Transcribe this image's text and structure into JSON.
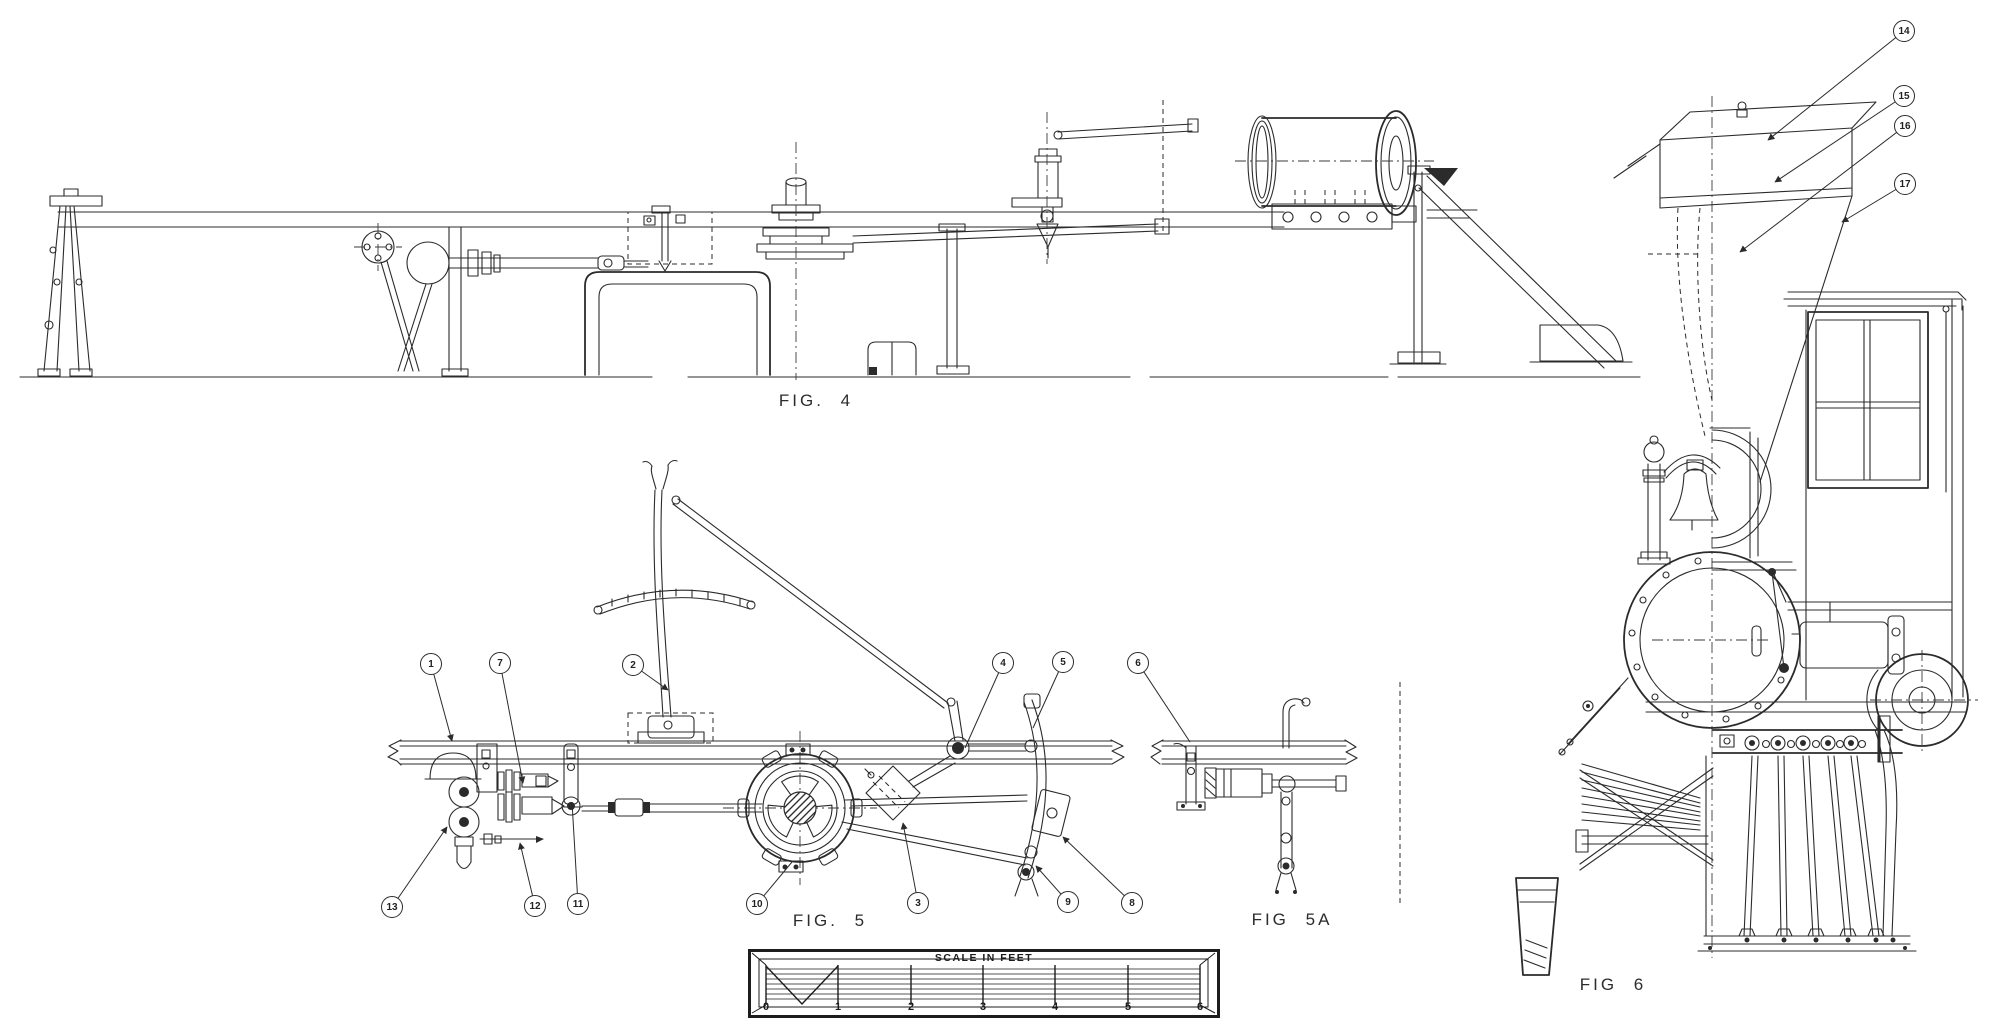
{
  "sheet": {
    "background": "#ffffff",
    "ink": "#2b2b2b"
  },
  "figures": {
    "fig4": {
      "label": "FIG. 4"
    },
    "fig5": {
      "label": "FIG. 5"
    },
    "fig5a": {
      "label": "FIG 5A"
    },
    "fig6": {
      "label": "FIG 6"
    }
  },
  "callouts": [
    {
      "label": "1"
    },
    {
      "label": "2"
    },
    {
      "label": "3"
    },
    {
      "label": "4"
    },
    {
      "label": "5"
    },
    {
      "label": "6"
    },
    {
      "label": "7"
    },
    {
      "label": "8"
    },
    {
      "label": "9"
    },
    {
      "label": "10"
    },
    {
      "label": "11"
    },
    {
      "label": "12"
    },
    {
      "label": "13"
    },
    {
      "label": "14"
    },
    {
      "label": "15"
    },
    {
      "label": "16"
    },
    {
      "label": "17"
    }
  ],
  "scale_bar": {
    "title": "SCALE IN FEET",
    "ticks": [
      "0",
      "1",
      "2",
      "3",
      "4",
      "5",
      "6"
    ]
  }
}
